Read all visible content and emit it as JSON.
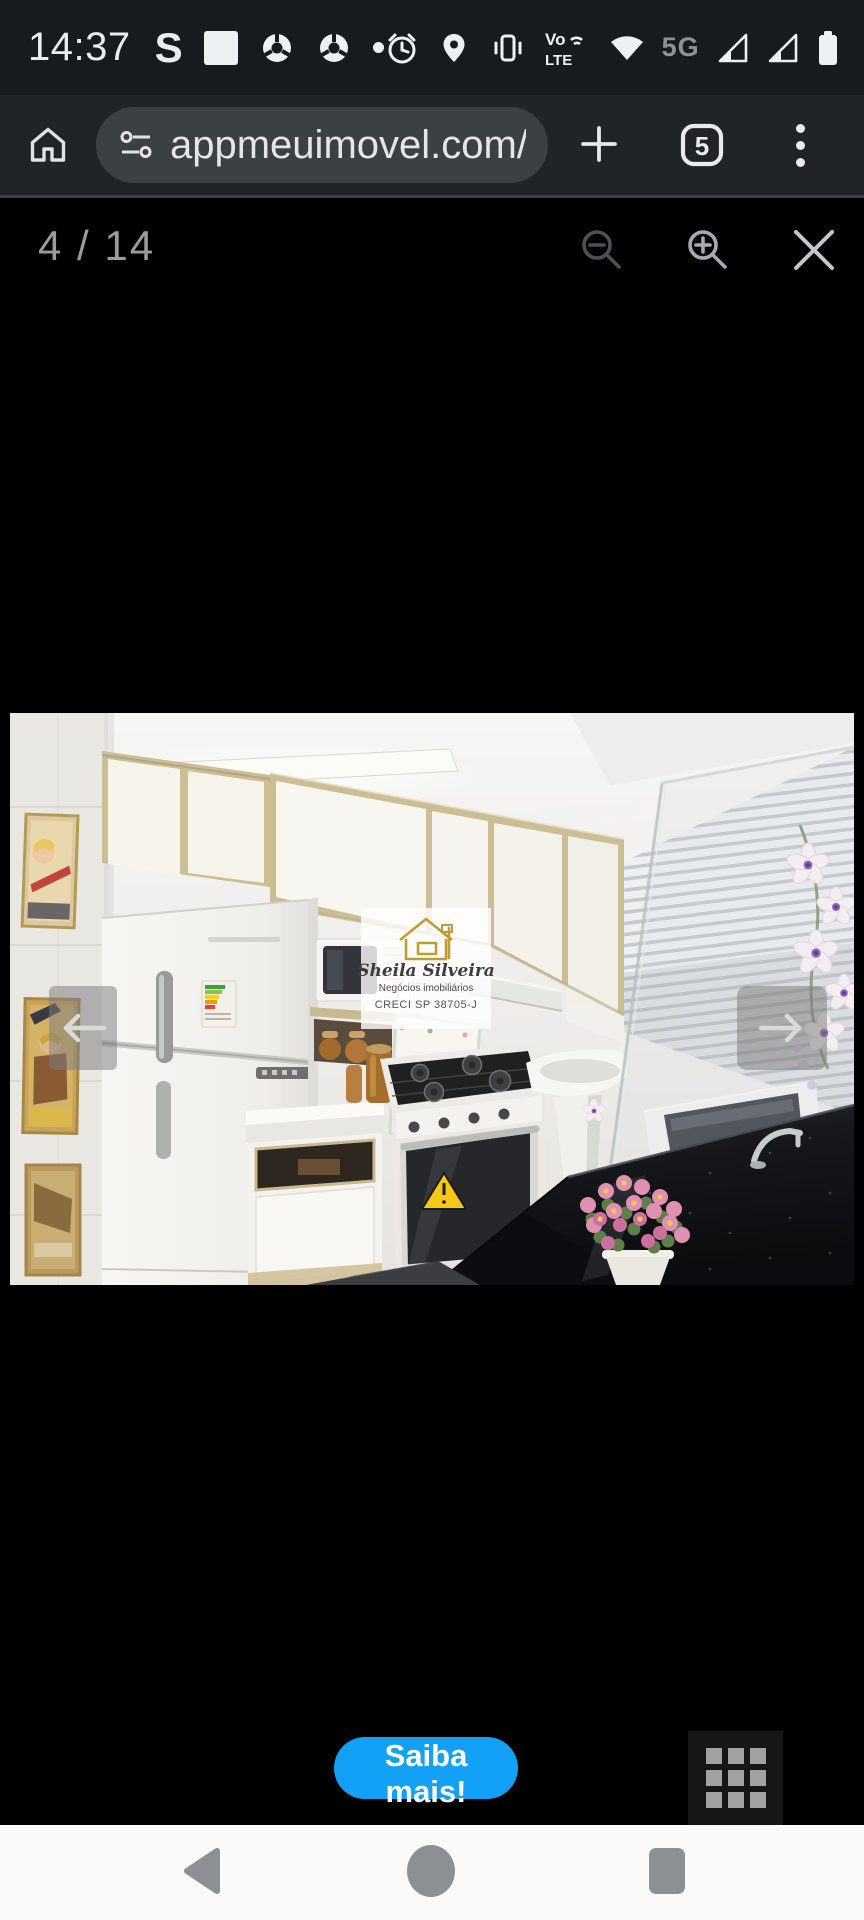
{
  "status_bar": {
    "time": "14:37",
    "s_badge": "S",
    "network_5g": "5G",
    "volte_top": "Vo",
    "volte_bottom": "LTE"
  },
  "browser": {
    "url": "appmeuimovel.com/lanc",
    "tab_count": "5"
  },
  "gallery": {
    "counter": "4 / 14",
    "cta_label": "Saiba mais!",
    "watermark": {
      "name": "Sheila Silveira",
      "subtitle": "Negócios imobiliários",
      "license": "CRECI SP 38705-J"
    }
  },
  "colors": {
    "status_bar_bg": "#171a1e",
    "toolbar_bg": "#202327",
    "urlbar_bg": "#3b4044",
    "content_bg": "#000000",
    "cta_blue": "#12a1f6",
    "navbar_bg": "#fafafa",
    "watermark_gold": "#bf9d36"
  }
}
